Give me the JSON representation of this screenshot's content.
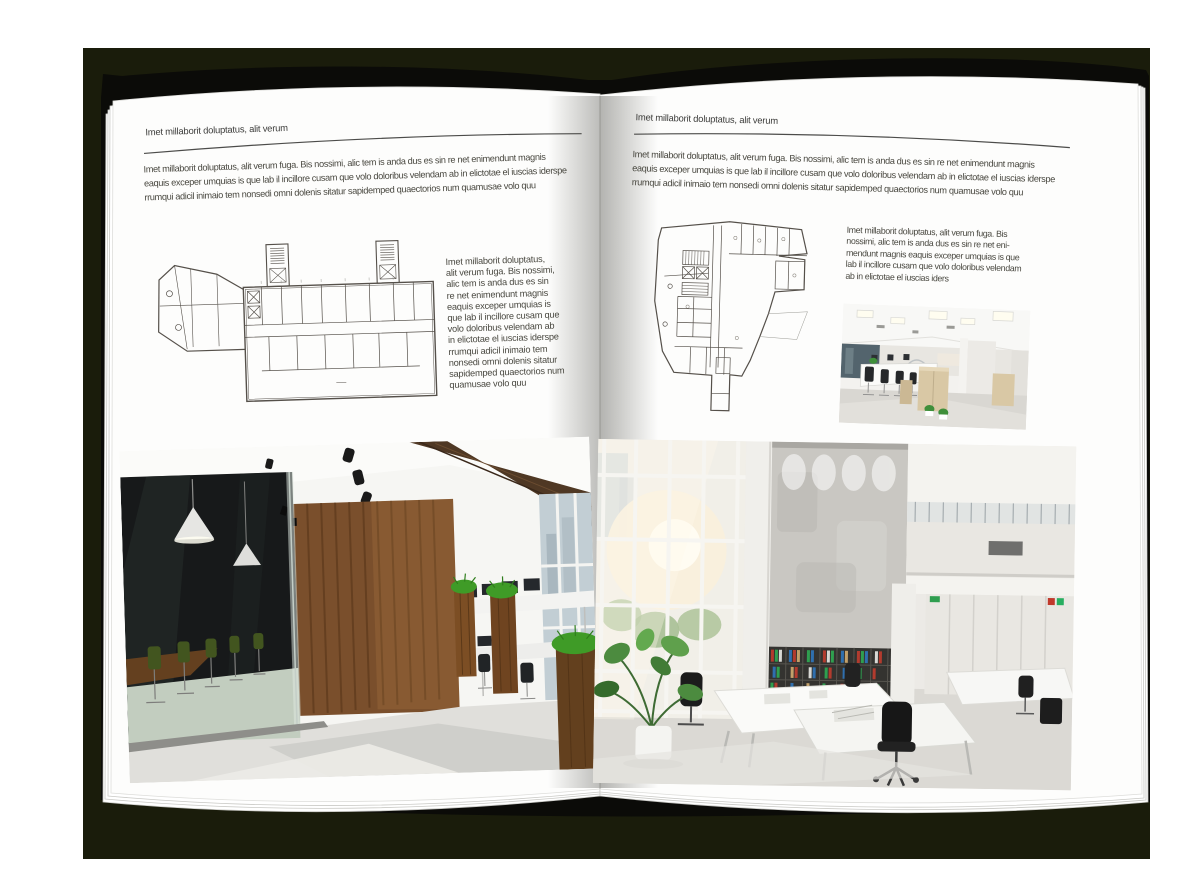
{
  "colors": {
    "backdrop": "#1a1c0b",
    "page": "#fdfdfc",
    "text": "#48473f",
    "plan_line": "#55504a"
  },
  "left_page": {
    "header": "Imet millaborit doluptatus, alit verum",
    "intro_lines": [
      "Imet millaborit doluptatus, alit verum fuga. Bis nossimi, alic tem is anda dus es sin re net enimendunt magnis",
      "eaquis exceper umquias is que lab il incillore cusam que volo doloribus velendam ab in elictotae el iuscias iderspe",
      "rrumqui adicil inimaio tem nonsedi omni dolenis sitatur sapidemped quaectorios num quamusae volo quu"
    ],
    "side_lines": [
      "Imet millaborit doluptatus,",
      "alit verum fuga. Bis nossimi,",
      "alic tem is anda dus es sin",
      "re net enimendunt magnis",
      "eaquis exceper umquias is",
      "que lab il incillore cusam que",
      "volo doloribus velendam ab",
      "in elictotae el iuscias iderspe",
      "rrumqui adicil inimaio tem",
      "nonsedi omni dolenis sitatur",
      "sapidemped quaectorios num",
      "quamusae volo quu"
    ]
  },
  "right_page": {
    "header": "Imet millaborit doluptatus, alit verum",
    "intro_lines": [
      "Imet millaborit doluptatus, alit verum fuga. Bis nossimi, alic tem is anda dus es sin re net enimendunt magnis",
      "eaquis exceper umquias is que lab il incillore cusam que volo doloribus velendam ab in elictotae el iuscias iderspe",
      "rrumqui adicil inimaio tem nonsedi omni dolenis sitatur sapidemped quaectorios num quamusae volo quu"
    ],
    "side_lines": [
      "Imet millaborit doluptatus, alit verum fuga. Bis",
      "nossimi, alic tem is anda dus es sin re net eni-",
      "mendunt magnis eaquis exceper umquias is que",
      "lab il incillore cusam que volo doloribus velendam",
      "ab in elictotae el iuscias iders"
    ]
  }
}
